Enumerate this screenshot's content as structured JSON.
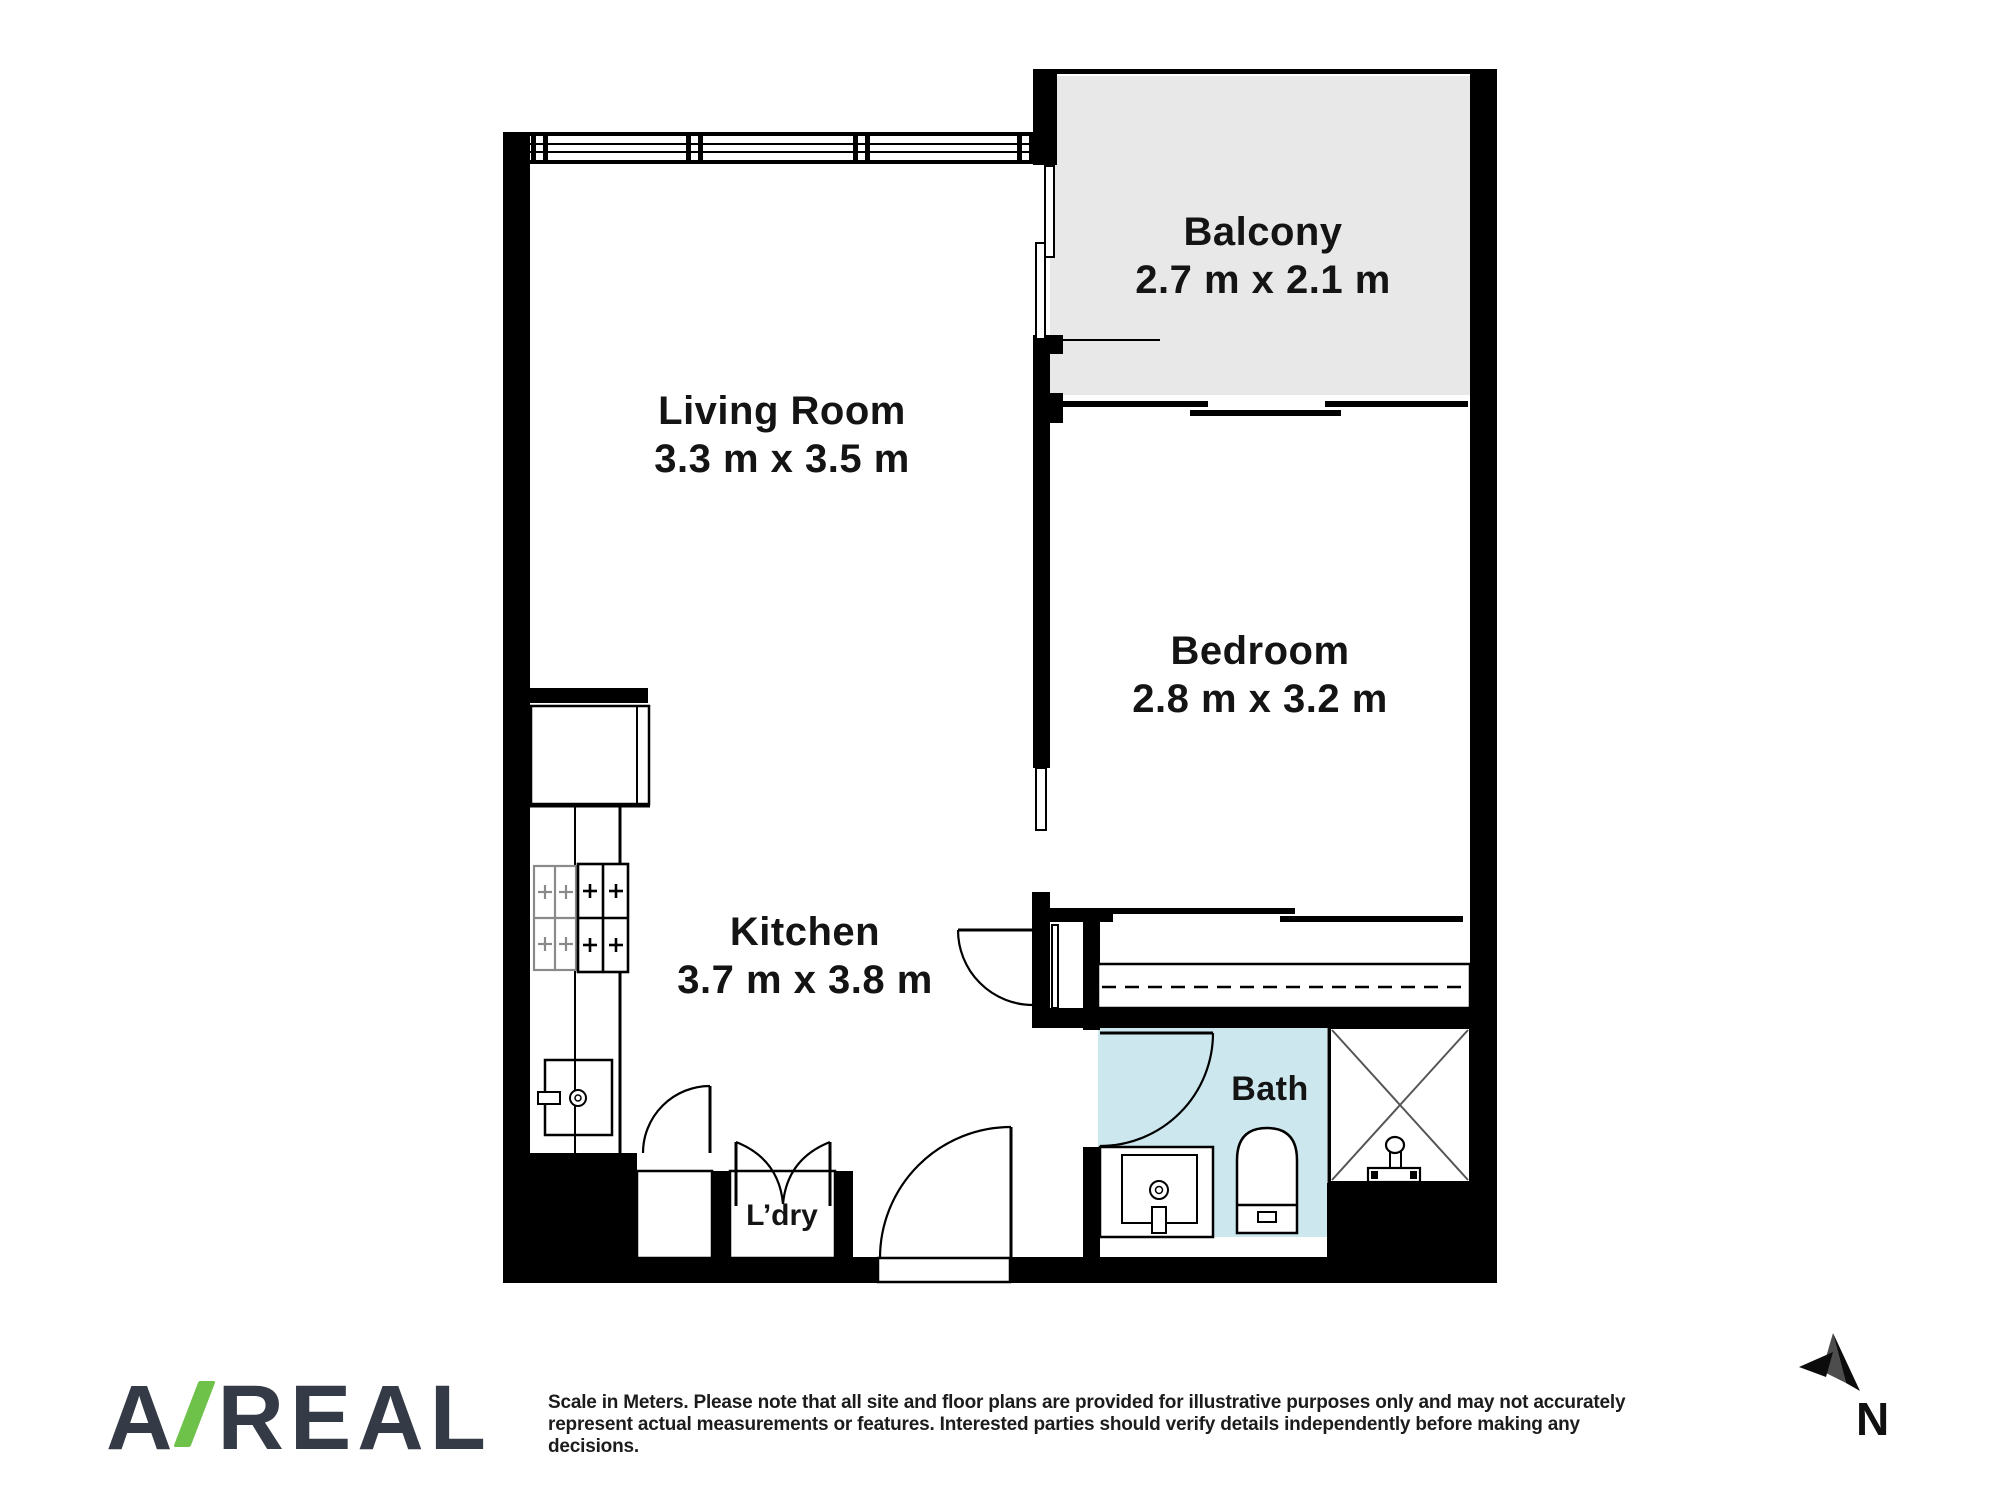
{
  "plan": {
    "rooms": [
      {
        "id": "balcony",
        "name": "Balcony",
        "dims": "2.7 m x 2.1 m"
      },
      {
        "id": "living-room",
        "name": "Living Room",
        "dims": "3.3 m x 3.5 m"
      },
      {
        "id": "bedroom",
        "name": "Bedroom",
        "dims": "2.8 m x 3.2 m"
      },
      {
        "id": "kitchen",
        "name": "Kitchen",
        "dims": "3.7 m x 3.8 m"
      },
      {
        "id": "bath",
        "name": "Bath"
      },
      {
        "id": "laundry",
        "name": "L’dry"
      }
    ],
    "fixtures": [
      "cooktop",
      "fridge",
      "kitchen-sink",
      "vanity-basin",
      "toilet",
      "shower",
      "built-in-robe",
      "entry-door",
      "bedroom-door",
      "bath-door",
      "laundry-double-door",
      "closet-door",
      "balcony-sliding-door"
    ],
    "colors": {
      "wall": "#000000",
      "balcony_floor": "#e8e8e8",
      "bath_floor": "#cce8ee",
      "shower_cross": "#555555"
    }
  },
  "footer": {
    "logo": {
      "part1": "A",
      "slash": "/",
      "part2": "REAL",
      "color_text": "#343b46",
      "color_slash": "#6ec149"
    },
    "disclaimer": {
      "line1": "Scale in Meters. Please note that all site and floor plans are provided for illustrative purposes only and may not accurately",
      "line2": "represent actual measurements or features. Interested parties should verify details independently before making any",
      "line3": "decisions."
    },
    "compass": {
      "label": "N"
    }
  }
}
